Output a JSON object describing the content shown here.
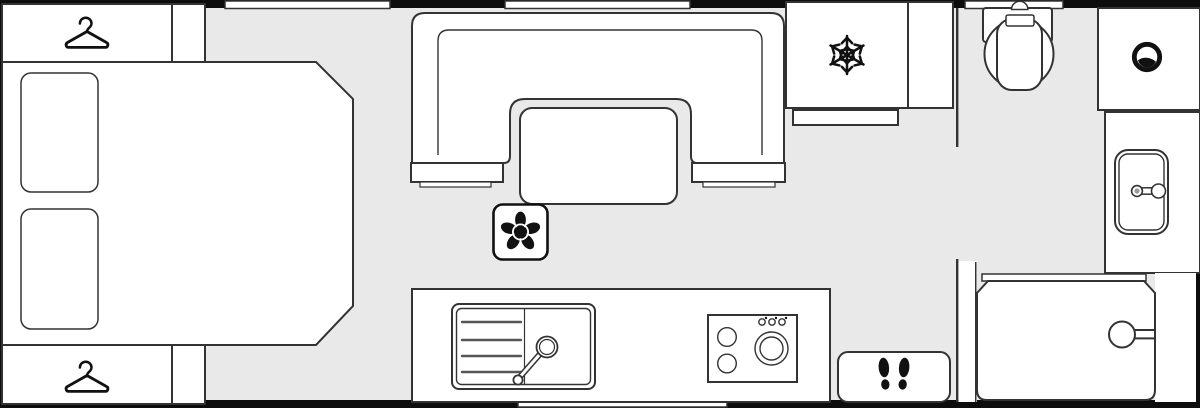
{
  "app": {
    "name": "Caravan floor plan",
    "view": "top-down layout diagram",
    "visible_text": ""
  },
  "floorplan": {
    "bedroom": {
      "front_wardrobe": {
        "icon": "clothes-hanger-icon"
      },
      "front_cupboard": {},
      "bed": {
        "kind": "double-bed-with-chamfered-foot",
        "pillow_count": 2
      },
      "rear_wardrobe": {
        "icon": "clothes-hanger-icon"
      },
      "rear_cupboard": {}
    },
    "lounge": {
      "seating": "u-shaped-dinette-with-backrest",
      "table": "freestanding-table",
      "plinths": 2
    },
    "kitchen": {
      "extractor": {
        "icon": "extractor-fan-icon"
      },
      "sink": {
        "kind": "sink-with-drainer",
        "drainer_grooves": 4,
        "tap": "swivel-tap"
      },
      "hob": {
        "small_burners": 2,
        "large_burners": 1,
        "control_knobs": 3
      }
    },
    "fridge": {
      "icon": "snowflake-icon"
    },
    "tall_cupboard": {},
    "washroom": {
      "toilet": "swivel-cassette-toilet",
      "vanity_icon": "round-basin-icon",
      "washbasin": {
        "kind": "rectangular-basin",
        "tap": "single-tap"
      },
      "shower": {
        "kind": "shower-enclosure",
        "screen": "straight-screen",
        "head": "shower-head-on-wall"
      }
    },
    "entrance": {
      "step": {
        "icon": "footprints-icon"
      }
    },
    "windows": {
      "front_wall": 3,
      "rear_wall": 1
    }
  },
  "colors": {
    "floor": "#e9e9e9",
    "furniture": "#ffffff",
    "outline": "#333333",
    "wall": "#0d0d0d",
    "icon": "#111111"
  }
}
